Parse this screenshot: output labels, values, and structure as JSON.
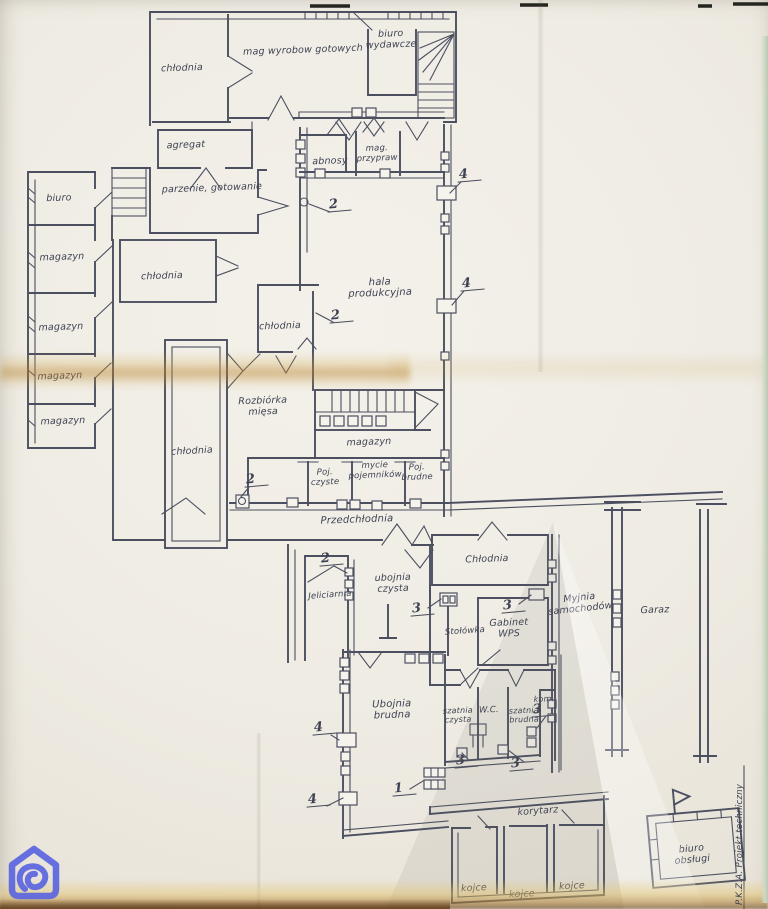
{
  "document": {
    "side_text": "P.K.Z.A. Projekt techniczny",
    "watermark_icon": "otodom-logo",
    "kind": "hand-drawn slaughterhouse floor plan on folded paper"
  },
  "colors": {
    "paper": "#f2efe8",
    "ink": "#4b4f60",
    "fold_tint": "#b5812c",
    "logo_blue": "#5b66e0",
    "table_edge_green": "#b9c9b0",
    "bottom_edge_brown": "#5a3410"
  },
  "plan": {
    "room_labels": [
      {
        "text": "chłodnia",
        "x": 182,
        "y": 69
      },
      {
        "text": "mag wyrobow gotowych",
        "x": 303,
        "y": 51
      },
      {
        "text": "biuro\nwydawcze",
        "x": 391,
        "y": 40
      },
      {
        "text": "agregat",
        "x": 186,
        "y": 146
      },
      {
        "text": "parzenie, gotowanie",
        "x": 212,
        "y": 189
      },
      {
        "text": "biuro",
        "x": 59,
        "y": 199
      },
      {
        "text": "magazyn",
        "x": 62,
        "y": 258
      },
      {
        "text": "chłodnia",
        "x": 162,
        "y": 277
      },
      {
        "text": "magazyn",
        "x": 61,
        "y": 328
      },
      {
        "text": "magazyn",
        "x": 60,
        "y": 377
      },
      {
        "text": "magazyn",
        "x": 63,
        "y": 422
      },
      {
        "text": "chłodnia",
        "x": 192,
        "y": 452,
        "rot": -3
      },
      {
        "text": "abnosy",
        "x": 330,
        "y": 162
      },
      {
        "text": "mag.\nprzypraw",
        "x": 377,
        "y": 154,
        "fs": 8.5
      },
      {
        "text": "hala\nprodukcyjna",
        "x": 380,
        "y": 288,
        "fs": 10
      },
      {
        "text": "chłodnia",
        "x": 280,
        "y": 327
      },
      {
        "text": "Rozbiórka\nmięsa",
        "x": 263,
        "y": 407
      },
      {
        "text": "magazyn",
        "x": 369,
        "y": 443
      },
      {
        "text": "Poj.\nczyste",
        "x": 325,
        "y": 478,
        "fs": 8.5
      },
      {
        "text": "mycie\npojemników",
        "x": 375,
        "y": 471,
        "fs": 8.5
      },
      {
        "text": "Poj.\nbrudne",
        "x": 417,
        "y": 473,
        "fs": 8.5
      },
      {
        "text": "Przedchłodnia",
        "x": 357,
        "y": 520,
        "fs": 10
      },
      {
        "text": "Chłodnia",
        "x": 487,
        "y": 560
      },
      {
        "text": "ubojnia\nczysta",
        "x": 393,
        "y": 584
      },
      {
        "text": "Jeliciarnia",
        "x": 330,
        "y": 596,
        "rot": -4,
        "fs": 8.5
      },
      {
        "text": "Myjnia\nsamochodów",
        "x": 580,
        "y": 604,
        "rot": -6
      },
      {
        "text": "Garaz",
        "x": 655,
        "y": 611
      },
      {
        "text": "Stołówka",
        "x": 465,
        "y": 632,
        "rot": -4,
        "fs": 8.5
      },
      {
        "text": "Gabinet\nWPS",
        "x": 509,
        "y": 629
      },
      {
        "text": "Ubojnia\nbrudna",
        "x": 392,
        "y": 710,
        "fs": 10
      },
      {
        "text": "szatnia\nczysta",
        "x": 458,
        "y": 716,
        "fs": 8
      },
      {
        "text": "W.C.",
        "x": 489,
        "y": 711,
        "fs": 8.5
      },
      {
        "text": "szatnia\nbrudna",
        "x": 524,
        "y": 716,
        "fs": 8
      },
      {
        "text": "kom.",
        "x": 544,
        "y": 700,
        "fs": 8
      },
      {
        "text": "korytarz",
        "x": 538,
        "y": 812,
        "rot": -4
      },
      {
        "text": "kojce",
        "x": 474,
        "y": 889,
        "rot": -3
      },
      {
        "text": "kojce",
        "x": 522,
        "y": 895,
        "rot": -3
      },
      {
        "text": "kojce",
        "x": 572,
        "y": 887,
        "rot": -3
      },
      {
        "text": "biuro\nobsługi",
        "x": 692,
        "y": 855,
        "rot": -5
      }
    ],
    "markers": [
      {
        "text": "2",
        "x": 339,
        "y": 206
      },
      {
        "text": "2",
        "x": 341,
        "y": 317
      },
      {
        "text": "2",
        "x": 256,
        "y": 481
      },
      {
        "text": "2",
        "x": 331,
        "y": 560
      },
      {
        "text": "4",
        "x": 469,
        "y": 176
      },
      {
        "text": "4",
        "x": 472,
        "y": 285
      },
      {
        "text": "4",
        "x": 324,
        "y": 729
      },
      {
        "text": "4",
        "x": 318,
        "y": 801
      },
      {
        "text": "3",
        "x": 422,
        "y": 610
      },
      {
        "text": "3",
        "x": 513,
        "y": 607
      },
      {
        "text": "3",
        "x": 543,
        "y": 711
      },
      {
        "text": "3",
        "x": 466,
        "y": 762
      },
      {
        "text": "3",
        "x": 521,
        "y": 765
      },
      {
        "text": "1",
        "x": 404,
        "y": 790
      }
    ]
  }
}
